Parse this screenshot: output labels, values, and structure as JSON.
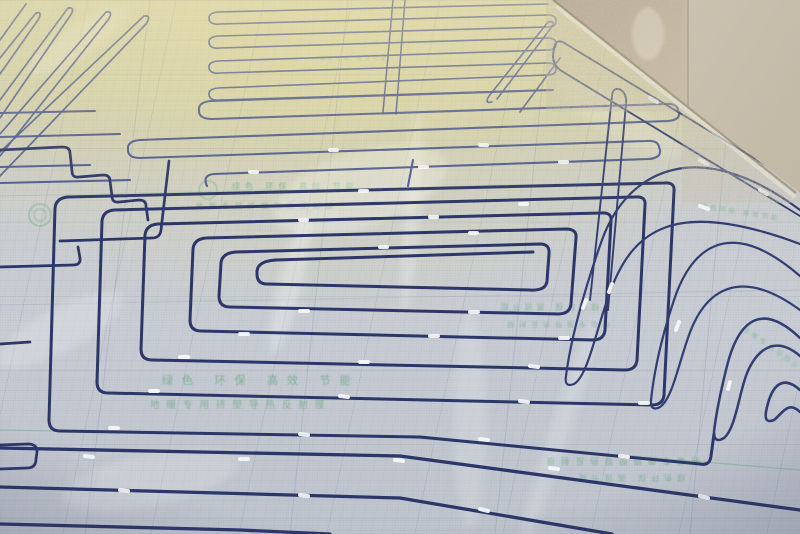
{
  "scene": {
    "description": "Construction photograph of a hydronic underfloor heating installation: blue PEX heating pipe fixed in a large rectangular spiral and serpentine loops on silver reflective insulation foil printed with a fine grid, green round logo stamps and green slogans; bare plaster walls meet the floor in the top-right corner and warm light falls across the distant floor.",
    "objects": [
      "blue heating pipe loops",
      "silver reflective insulation foil",
      "printed measuring grid",
      "white pipe fixing clips",
      "green round logo stamps",
      "green printed slogans",
      "bare plaster wall"
    ]
  },
  "foil_print": {
    "slogan": "绿色 环保 高效 节能",
    "product": "地暖专用挤塑导热反射膜",
    "slogan_compact": "绿色环保 高效节能",
    "product_compact": "地暖专用导热反射膜"
  },
  "colors": {
    "pipe": "#2c3669",
    "pipe_far": "#4a5790",
    "pipe_right": "#323e72",
    "clip": "#f4f6f9",
    "print_green": "#3f9e62",
    "grid_line": "#5a7090",
    "foil": "#ccd0d6",
    "foil_tint": "#d8d2a0",
    "wall": "#b7a88f",
    "wall_smooth": "#ccc3b1"
  }
}
